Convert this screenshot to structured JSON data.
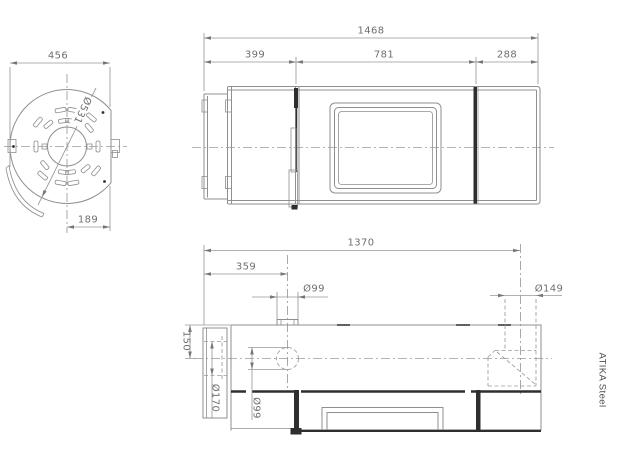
{
  "title": "ATIKA Steel",
  "views": {
    "rear": {
      "width": "456",
      "diameter": "Ø531",
      "center_offset": "189"
    },
    "front": {
      "total_width": "1468",
      "left_section": "399",
      "door_section": "781",
      "right_section": "288"
    },
    "plan": {
      "length_to_flue_center": "1370",
      "flue_offset": "359",
      "top_flue_diameter": "Ø99",
      "rear_flue_diameter": "Ø149",
      "flue_height_offset": "150",
      "side_hub_diameter": "Ø170",
      "bottom_outlet_diameter": "Ø99"
    }
  }
}
